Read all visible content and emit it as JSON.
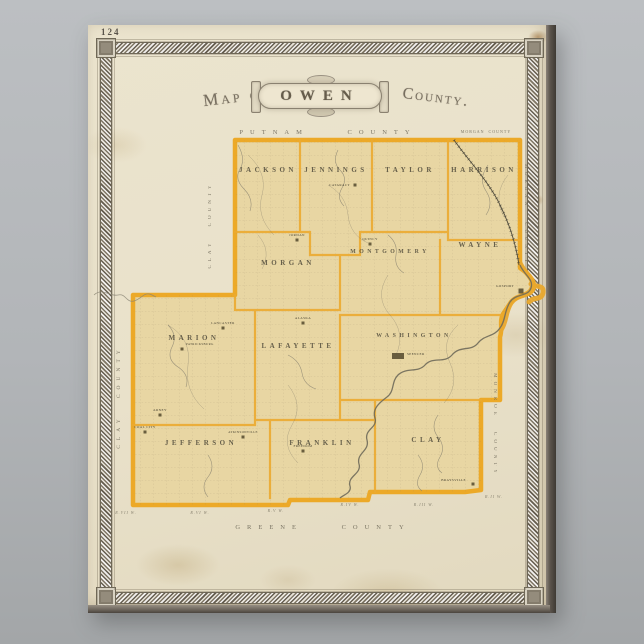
{
  "page_number": "124",
  "title": {
    "prefix": "Map of",
    "name": "OWEN",
    "suffix": "County."
  },
  "colors": {
    "background": "#b2b5b8",
    "paper": "#e9e1cb",
    "frame": "#8f897b",
    "county_border": "#eca928",
    "township_fill": "#e8d6a3",
    "river_highlight": "#e9a82e"
  },
  "map": {
    "townships": [
      {
        "name": "JACKSON",
        "x": 180,
        "y": 147
      },
      {
        "name": "JENNINGS",
        "x": 248,
        "y": 147
      },
      {
        "name": "TAYLOR",
        "x": 322,
        "y": 147
      },
      {
        "name": "HARRISON",
        "x": 396,
        "y": 147
      },
      {
        "name": "MORGAN",
        "x": 200,
        "y": 240
      },
      {
        "name": "MONTGOMERY",
        "x": 302,
        "y": 228
      },
      {
        "name": "WAYNE",
        "x": 392,
        "y": 222
      },
      {
        "name": "MARION",
        "x": 106,
        "y": 315
      },
      {
        "name": "LAFAYETTE",
        "x": 210,
        "y": 323
      },
      {
        "name": "WASHINGTON",
        "x": 326,
        "y": 312
      },
      {
        "name": "JEFFERSON",
        "x": 113,
        "y": 420
      },
      {
        "name": "FRANKLIN",
        "x": 234,
        "y": 420
      },
      {
        "name": "CLAY",
        "x": 340,
        "y": 417
      }
    ],
    "towns": [
      {
        "name": "CATARACT",
        "x": 267,
        "y": 160,
        "lx": 262,
        "ly": 161,
        "anchor": "end"
      },
      {
        "name": "JORDAN",
        "x": 209,
        "y": 215,
        "lx": 209,
        "ly": 211
      },
      {
        "name": "QUINCY",
        "x": 282,
        "y": 219,
        "lx": 282,
        "ly": 215
      },
      {
        "name": "GOSPORT",
        "x": 433,
        "y": 266,
        "w": 5,
        "h": 5,
        "lx": 426,
        "ly": 262,
        "anchor": "end"
      },
      {
        "name": "SPENCER",
        "x": 310,
        "y": 331,
        "w": 12,
        "h": 6,
        "lx": 319,
        "ly": 330,
        "anchor": "start"
      },
      {
        "name": "LANCASTER",
        "x": 135,
        "y": 303,
        "lx": 135,
        "ly": 299
      },
      {
        "name": "PATRICKSBURG",
        "x": 94,
        "y": 324,
        "lx": 98,
        "ly": 320,
        "anchor": "start"
      },
      {
        "name": "ALASKA",
        "x": 215,
        "y": 298,
        "lx": 215,
        "ly": 294
      },
      {
        "name": "ARNEY",
        "x": 72,
        "y": 390,
        "lx": 72,
        "ly": 386
      },
      {
        "name": "COAL CITY",
        "x": 57,
        "y": 407,
        "lx": 57,
        "ly": 403
      },
      {
        "name": "ATKINSONVILLE",
        "x": 155,
        "y": 412,
        "lx": 155,
        "ly": 408
      },
      {
        "name": "FREEDOM",
        "x": 215,
        "y": 426,
        "lx": 215,
        "ly": 422
      },
      {
        "name": "BRAYSVILLE",
        "x": 385,
        "y": 459,
        "lx": 378,
        "ly": 456,
        "anchor": "end"
      }
    ],
    "neighbor_labels": [
      {
        "name": "PUTNAM COUNTY",
        "x": 240,
        "y": 109,
        "rot": 0,
        "fs": 6.5,
        "ls": 7,
        "ws": 30
      },
      {
        "name": "MORGAN COUNTY",
        "x": 398,
        "y": 108,
        "rot": 0,
        "fs": 4,
        "ls": 1,
        "ws": 2
      },
      {
        "name": "MORGAN COUNTY",
        "x": 437,
        "y": 190,
        "rot": 90,
        "fs": 4.8,
        "ls": 4,
        "ws": 8
      },
      {
        "name": "MONROE COUNTY",
        "x": 406,
        "y": 400,
        "rot": 90,
        "fs": 5,
        "ls": 4,
        "ws": 8
      },
      {
        "name": "CLAY COUNTY",
        "x": 123,
        "y": 200,
        "rot": -90,
        "fs": 5,
        "ls": 4,
        "ws": 8
      },
      {
        "name": "CLAY COUNTY",
        "x": 32,
        "y": 372,
        "rot": -90,
        "fs": 5.5,
        "ls": 5,
        "ws": 10
      },
      {
        "name": "GREENE COUNTY",
        "x": 235,
        "y": 504,
        "rot": 0,
        "fs": 6.5,
        "ls": 7,
        "ws": 30
      }
    ],
    "range_labels": [
      {
        "name": "R.VII W.",
        "x": 38,
        "y": 489
      },
      {
        "name": "R.VI W.",
        "x": 112,
        "y": 489
      },
      {
        "name": "R.V W.",
        "x": 188,
        "y": 487
      },
      {
        "name": "R.IV W.",
        "x": 262,
        "y": 481
      },
      {
        "name": "R.III W.",
        "x": 336,
        "y": 481
      },
      {
        "name": "R.II W.",
        "x": 406,
        "y": 473
      }
    ]
  }
}
